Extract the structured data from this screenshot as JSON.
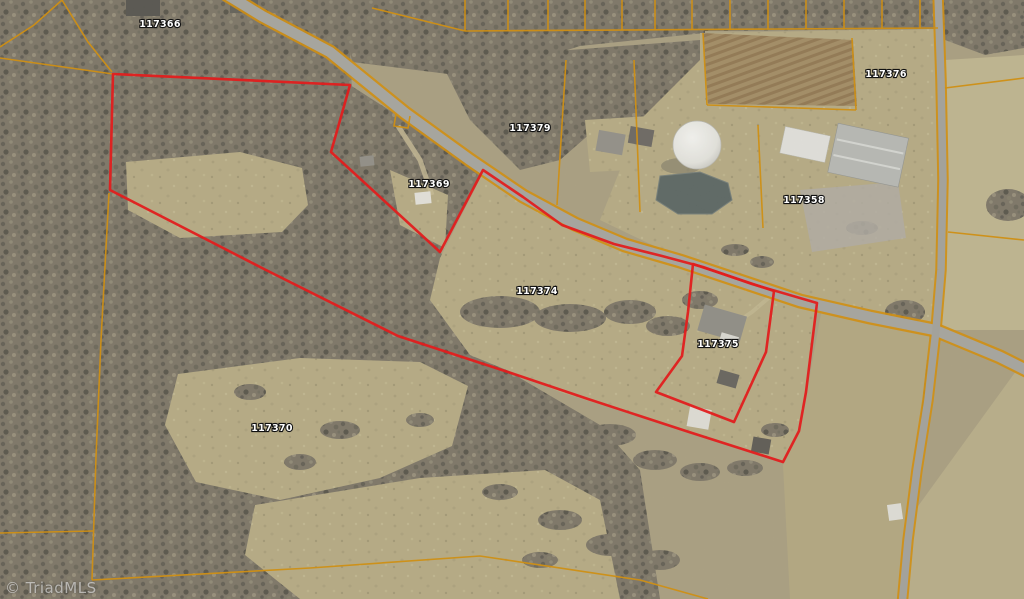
{
  "map": {
    "watermark": "© TriadMLS",
    "colors": {
      "boundary_red": "#e21d1d",
      "parcel_orange": "#cf8f14",
      "road_gray": "#a6a59e",
      "cross_road_gray": "#a3a29b"
    },
    "parcel_labels": [
      {
        "id": "117366",
        "x": 160,
        "y": 27
      },
      {
        "id": "117376",
        "x": 886,
        "y": 77
      },
      {
        "id": "117379",
        "x": 530,
        "y": 131
      },
      {
        "id": "117369",
        "x": 429,
        "y": 187
      },
      {
        "id": "117358",
        "x": 804,
        "y": 203
      },
      {
        "id": "117374",
        "x": 537,
        "y": 294
      },
      {
        "id": "117375",
        "x": 718,
        "y": 347
      },
      {
        "id": "117370",
        "x": 272,
        "y": 431
      }
    ],
    "red_parcels": [
      {
        "name": "boundary-main",
        "points": [
          [
            113,
            74
          ],
          [
            350,
            85
          ],
          [
            331,
            152
          ],
          [
            440,
            252
          ],
          [
            483,
            170
          ],
          [
            523,
            197
          ],
          [
            562,
            225
          ],
          [
            614,
            244
          ],
          [
            662,
            256
          ],
          [
            703,
            267
          ],
          [
            752,
            284
          ],
          [
            817,
            303
          ],
          [
            806,
            392
          ],
          [
            799,
            431
          ],
          [
            783,
            462
          ],
          [
            689,
            432
          ],
          [
            588,
            399
          ],
          [
            508,
            372
          ],
          [
            398,
            336
          ],
          [
            264,
            269
          ],
          [
            110,
            190
          ]
        ]
      },
      {
        "name": "boundary-117375",
        "points": [
          [
            693,
            264
          ],
          [
            774,
            291
          ],
          [
            766,
            352
          ],
          [
            734,
            422
          ],
          [
            656,
            392
          ],
          [
            682,
            356
          ],
          [
            688,
            312
          ]
        ]
      }
    ],
    "parcel_lines": [
      {
        "points": [
          [
            372,
            8
          ],
          [
            465,
            31
          ]
        ]
      },
      {
        "points": [
          [
            62,
            0
          ],
          [
            34,
            25
          ],
          [
            0,
            47
          ]
        ]
      },
      {
        "points": [
          [
            62,
            0
          ],
          [
            88,
            42
          ],
          [
            112,
            72
          ]
        ]
      },
      {
        "points": [
          [
            0,
            58
          ],
          [
            113,
            74
          ]
        ]
      },
      {
        "points": [
          [
            109,
            193
          ],
          [
            101,
            340
          ],
          [
            96,
            457
          ],
          [
            92,
            580
          ]
        ]
      },
      {
        "points": [
          [
            0,
            533
          ],
          [
            93,
            531
          ]
        ]
      },
      {
        "points": [
          [
            92,
            580
          ],
          [
            310,
            568
          ],
          [
            480,
            556
          ],
          [
            640,
            580
          ],
          [
            708,
            599
          ]
        ]
      },
      {
        "points": [
          [
            566,
            60
          ],
          [
            557,
            205
          ]
        ]
      },
      {
        "points": [
          [
            634,
            60
          ],
          [
            640,
            212
          ]
        ]
      },
      {
        "points": [
          [
            703,
            33
          ],
          [
            707,
            105
          ]
        ]
      },
      {
        "points": [
          [
            707,
            105
          ],
          [
            856,
            110
          ]
        ]
      },
      {
        "points": [
          [
            852,
            38
          ],
          [
            856,
            110
          ]
        ]
      },
      {
        "points": [
          [
            945,
            88
          ],
          [
            1024,
            78
          ]
        ]
      },
      {
        "points": [
          [
            948,
            232
          ],
          [
            1024,
            240
          ]
        ]
      },
      {
        "points": [
          [
            396,
            114
          ],
          [
            394,
            126
          ],
          [
            408,
            128
          ],
          [
            410,
            116
          ]
        ]
      },
      {
        "points": [
          [
            758,
            125
          ],
          [
            763,
            228
          ]
        ]
      }
    ],
    "top_strip": {
      "line": [
        [
          465,
          31
        ],
        [
          938,
          28
        ]
      ],
      "x_dividers": [
        465,
        508,
        548,
        585,
        622,
        655,
        692,
        730,
        768,
        806,
        844,
        882,
        920
      ]
    },
    "roads": [
      {
        "name": "main-road",
        "casing": 15,
        "width": 10.5,
        "gray": "#a6a59e",
        "points": [
          [
            226,
            -6
          ],
          [
            262,
            16
          ],
          [
            330,
            52
          ],
          [
            405,
            113
          ],
          [
            470,
            160
          ],
          [
            523,
            196
          ],
          [
            575,
            224
          ],
          [
            625,
            245
          ],
          [
            680,
            261
          ],
          [
            740,
            281
          ],
          [
            800,
            301
          ],
          [
            870,
            317
          ],
          [
            935,
            330
          ],
          [
            1000,
            357
          ],
          [
            1030,
            372
          ]
        ]
      },
      {
        "name": "cross-road",
        "casing": 11.5,
        "width": 7.5,
        "gray": "#a3a29b",
        "points": [
          [
            938,
            -6
          ],
          [
            941,
            80
          ],
          [
            943,
            180
          ],
          [
            941,
            270
          ],
          [
            936,
            330
          ],
          [
            928,
            400
          ],
          [
            917,
            470
          ],
          [
            908,
            540
          ],
          [
            902,
            606
          ]
        ]
      }
    ]
  }
}
